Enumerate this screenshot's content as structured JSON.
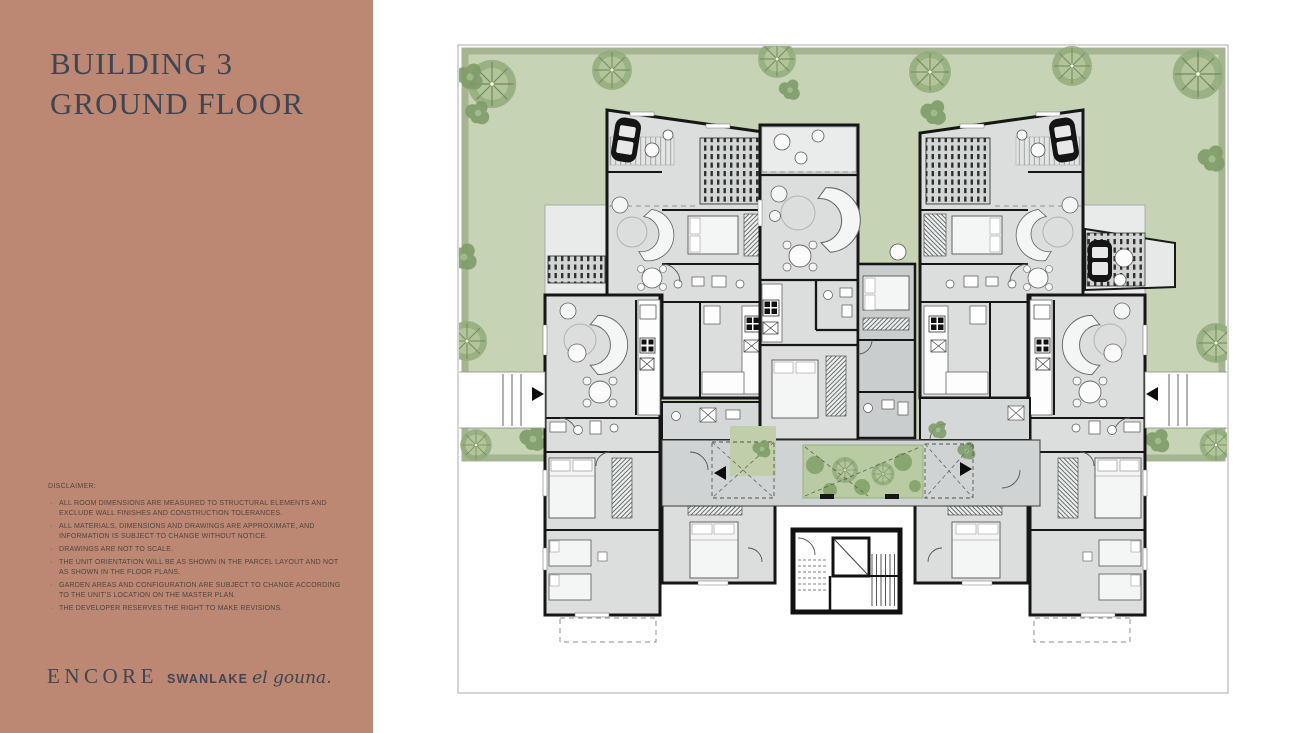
{
  "panel": {
    "title_line1": "BUILDING 3",
    "title_line2": "GROUND FLOOR",
    "disclaimer": {
      "heading": "DISCLAIMER:",
      "items": [
        "ALL ROOM DIMENSIONS ARE MEASURED TO STRUCTURAL ELEMENTS AND EXCLUDE WALL FINISHES AND CONSTRUCTION TOLERANCES.",
        "ALL MATERIALS, DIMENSIONS AND DRAWINGS ARE APPROXIMATE, AND INFORMATION IS SUBJECT TO CHANGE WITHOUT NOTICE.",
        "DRAWINGS ARE NOT TO SCALE.",
        "THE UNIT ORIENTATION WILL BE AS SHOWN IN THE PARCEL LAYOUT AND NOT AS SHOWN IN THE FLOOR PLANS.",
        "GARDEN AREAS AND CONFIGURATION ARE SUBJECT TO CHANGE ACCORDING TO THE UNIT'S LOCATION ON THE MASTER PLAN.",
        "THE DEVELOPER RESERVES THE RIGHT TO MAKE REVISIONS."
      ]
    },
    "logo": {
      "encore": "ENCORE",
      "swanlake": "SWANLAKE",
      "elgouna": "el gouna."
    }
  },
  "plan": {
    "colors": {
      "panel_bg": "#bc8773",
      "title_text": "#3e4553",
      "disclaimer_text": "#55453e",
      "page_bg": "#ffffff",
      "plan_border": "#a8adad",
      "garden_green": "#c6d3b5",
      "garden_border": "#a6b591",
      "tree_green": "#94ad7d",
      "bush_green": "#7d9b67",
      "courtyard_green": "#b9cba2",
      "building_gray": "#dcdede",
      "building_dark_gray": "#c9cdcd",
      "wall_black": "#161616",
      "furniture_fill": "#f4f5f5"
    },
    "features": [
      "garden-area",
      "garden-trees",
      "left-unit",
      "right-unit",
      "center-units",
      "pergola-terraces",
      "entrance-walkways",
      "central-courtyard",
      "stair-elevator-core"
    ]
  }
}
